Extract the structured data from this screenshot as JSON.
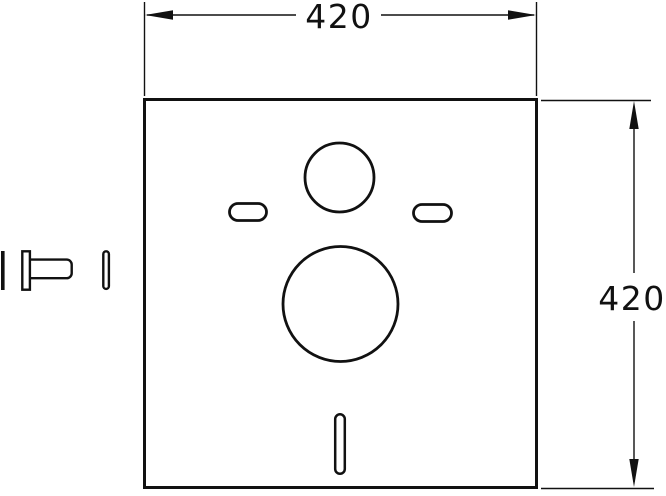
{
  "colors": {
    "line": "#111111",
    "background": "#ffffff"
  },
  "drawing": {
    "horizontal_dimension": {
      "value": "420"
    },
    "vertical_dimension": {
      "value": "420"
    }
  }
}
